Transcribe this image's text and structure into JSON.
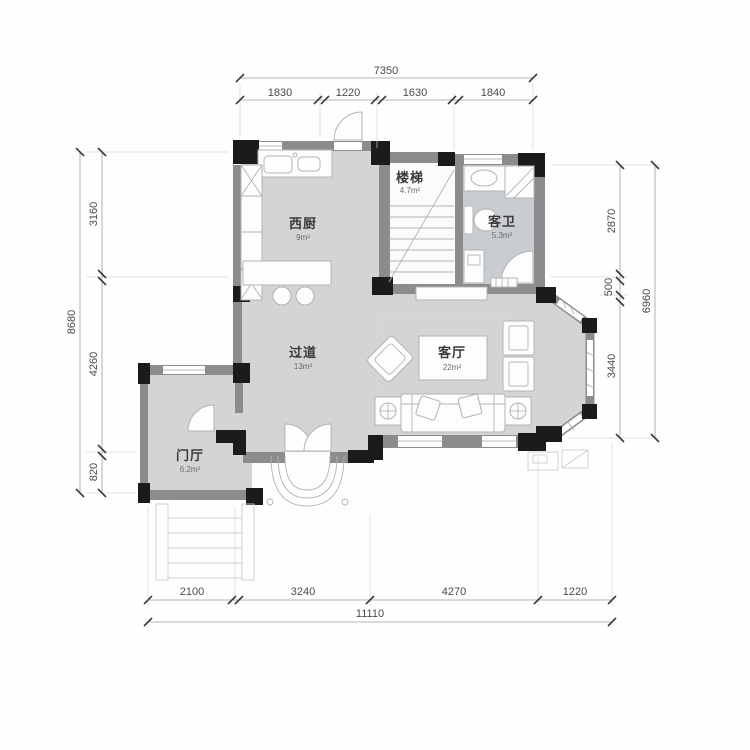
{
  "title": "residential-floor-plan",
  "colors": {
    "wall": "#8c8c8e",
    "pillar": "#1b1b1b",
    "room_fill": "#d4d4d4",
    "bath_fill": "#c9ccd0",
    "dim_text": "#4a4a4a",
    "furniture_stroke": "#b3b3b3",
    "background": "#ffffff"
  },
  "dimensions": {
    "top": {
      "total": "7350",
      "segments": [
        "1830",
        "1220",
        "1630",
        "1840"
      ]
    },
    "left": {
      "total": "8680",
      "segments": [
        "3160",
        "4260",
        "820"
      ]
    },
    "right": {
      "total": "6960",
      "segments": [
        "2870",
        "500",
        "3440"
      ]
    },
    "bottom": {
      "total": "11110",
      "segments": [
        "2100",
        "3240",
        "4270",
        "1220"
      ]
    }
  },
  "rooms": {
    "kitchen": {
      "name": "西厨",
      "area": "9m²"
    },
    "stairs": {
      "name": "楼梯",
      "area": "4.7m²"
    },
    "bathroom": {
      "name": "客卫",
      "area": "5.3m²"
    },
    "corridor": {
      "name": "过道",
      "area": "13m²"
    },
    "living": {
      "name": "客厅",
      "area": "22m²"
    },
    "foyer": {
      "name": "门厅",
      "area": "6.2m²"
    }
  }
}
